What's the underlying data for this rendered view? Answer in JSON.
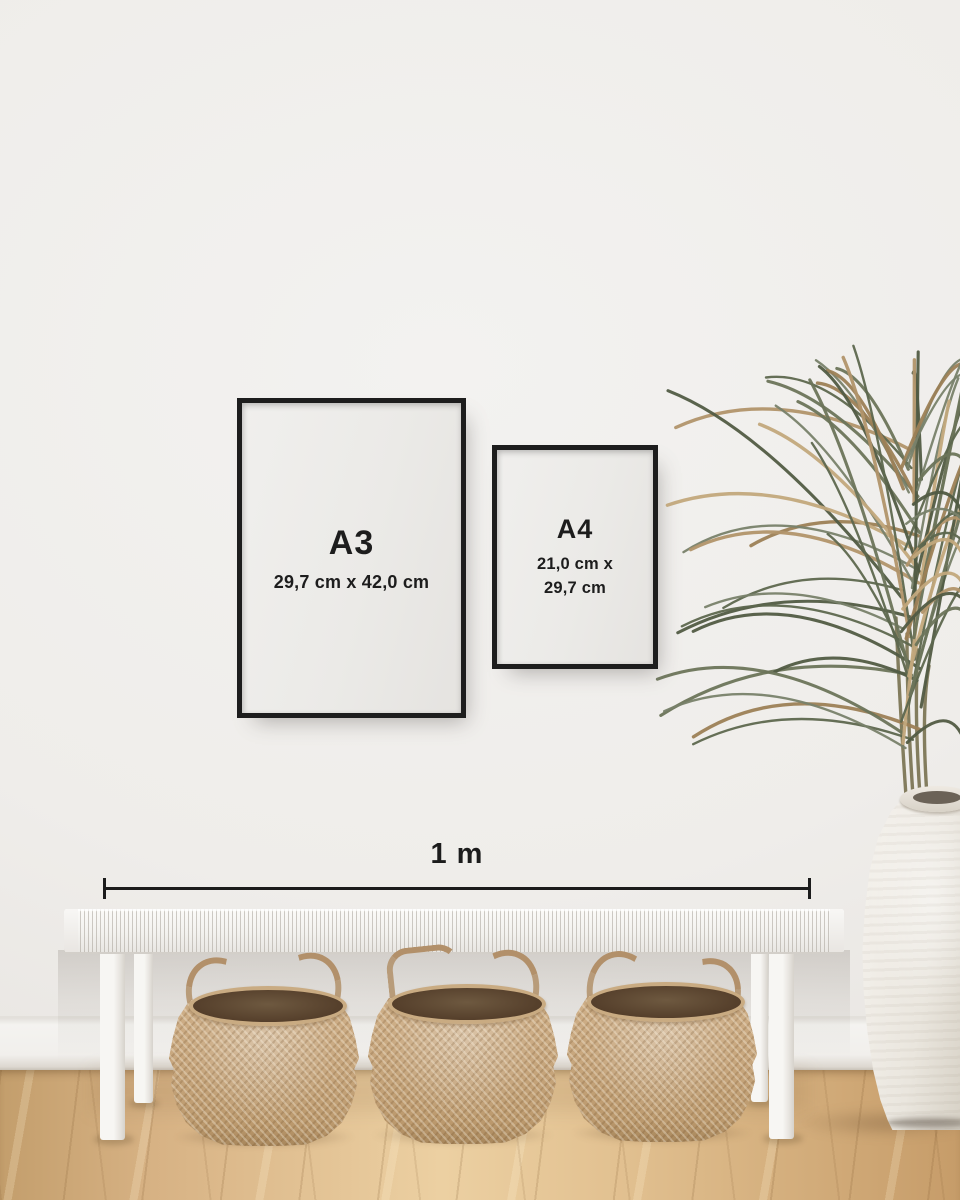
{
  "ruler": {
    "label": "1 m"
  },
  "frames": {
    "a3": {
      "label": "A3",
      "dimensions": "29,7 cm x 42,0 cm"
    },
    "a4": {
      "label": "A4",
      "dimensions_line1": "21,0 cm x",
      "dimensions_line2": "29,7 cm"
    }
  },
  "colors": {
    "wall": "#efedea",
    "baseboard": "#f3f2ef",
    "floor_light": "#ecd0a2",
    "floor_mid": "#d7b284",
    "floor_dark": "#c39e6c",
    "frame_border": "#1d1d1d",
    "frame_mat": "#ebeae7",
    "text": "#1d1d1d",
    "bench_white": "#f3f2ef",
    "basket_tan": "#c6a57c",
    "basket_interior": "#553f2b",
    "rope_handle": "#b2906a",
    "plant_green": "#667054",
    "plant_dried": "#b4986c",
    "vase_white": "#efece6"
  }
}
